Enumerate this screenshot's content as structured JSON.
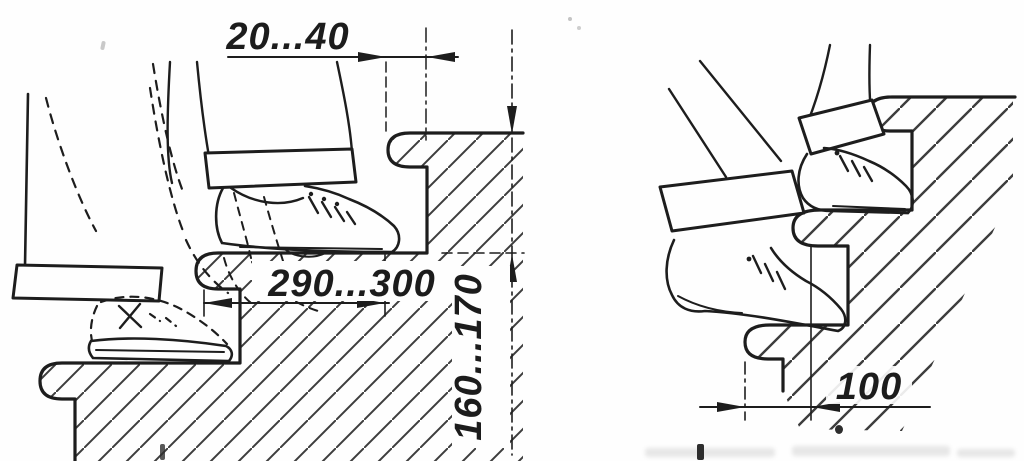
{
  "figure": {
    "kind": "stair-step-ergonomics-technical-drawing",
    "colors": {
      "background": "#fefefe",
      "ink": "#1d1d1d",
      "hatch": "#3d3d3d"
    },
    "left_drawing": {
      "name": "stair-with-correct-tread-side-view",
      "labels": {
        "nosing_overhang": "20...40",
        "tread_depth": "290...300",
        "riser_height": "160...170"
      }
    },
    "right_drawing": {
      "name": "stair-with-narrow-tread-side-view",
      "labels": {
        "tread_width_narrow": "100"
      }
    }
  }
}
